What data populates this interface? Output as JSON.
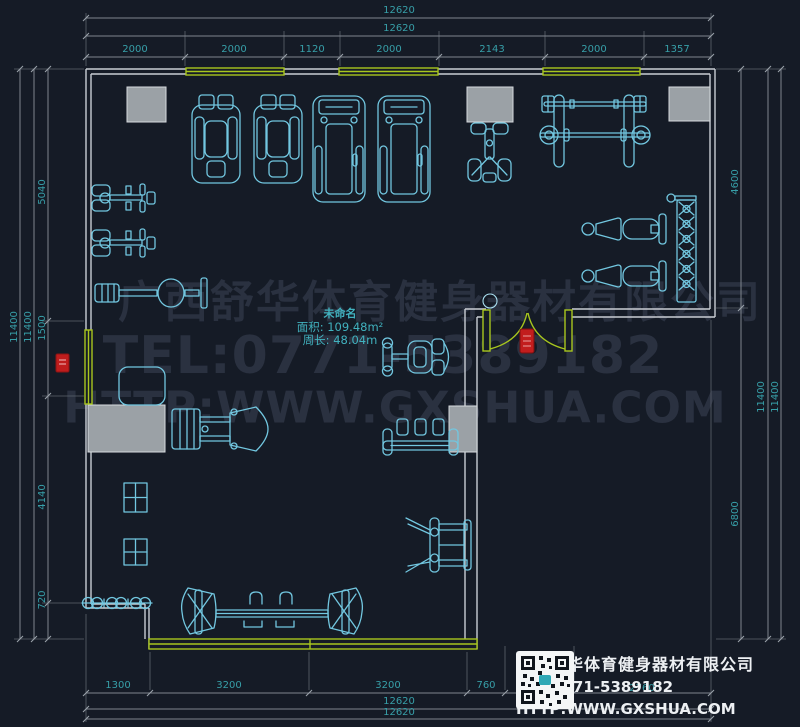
{
  "colors": {
    "background": "#151b26",
    "equipment_line": "#72c7e0",
    "wall_line": "#c9ced4",
    "window_green": "#a8c61e",
    "column_gray": "#9ba1a6",
    "dimension_text": "#379fa8",
    "watermark_gray": "#2a3140",
    "safety_red": "#c21d1d",
    "title_text": "#edf0f3"
  },
  "watermark": {
    "line1": "广西舒华体育健身器材有限公司",
    "line2": "TEL:0771-5389182",
    "line3": "HTTP:WWW.GXSHUA.COM"
  },
  "room_info": {
    "name": "未命名",
    "area": "面积: 109.48m²",
    "perimeter": "周长: 48.04m"
  },
  "title_block": {
    "company": "广西舒华体育健身器材有限公司",
    "tel": "TEL:0771-5389182",
    "website": "HTTP:WWW.GXSHUA.COM"
  },
  "dimensions": {
    "top": [
      {
        "text": "12620",
        "x": 399,
        "y": 11
      },
      {
        "text": "12620",
        "x": 399,
        "y": 29
      },
      {
        "text": "2000",
        "x": 135,
        "y": 50
      },
      {
        "text": "2000",
        "x": 234,
        "y": 50
      },
      {
        "text": "1120",
        "x": 312,
        "y": 50
      },
      {
        "text": "2000",
        "x": 389,
        "y": 50
      },
      {
        "text": "2143",
        "x": 492,
        "y": 50
      },
      {
        "text": "2000",
        "x": 594,
        "y": 50
      },
      {
        "text": "1357",
        "x": 677,
        "y": 50
      }
    ],
    "left": [
      {
        "text": "11400",
        "x": 15,
        "y": 327,
        "rot": 1
      },
      {
        "text": "11400",
        "x": 29,
        "y": 327,
        "rot": 1
      },
      {
        "text": "5040",
        "x": 43,
        "y": 192,
        "rot": 1
      },
      {
        "text": "1500",
        "x": 43,
        "y": 328,
        "rot": 1
      },
      {
        "text": "4140",
        "x": 43,
        "y": 497,
        "rot": 1
      },
      {
        "text": "720",
        "x": 43,
        "y": 600,
        "rot": 1
      }
    ],
    "right": [
      {
        "text": "4600",
        "x": 736,
        "y": 182,
        "rot": 1
      },
      {
        "text": "11400",
        "x": 762,
        "y": 397,
        "rot": 1
      },
      {
        "text": "11400",
        "x": 776,
        "y": 397,
        "rot": 1
      },
      {
        "text": "6800",
        "x": 736,
        "y": 514,
        "rot": 1
      }
    ],
    "bottom": [
      {
        "text": "1300",
        "x": 118,
        "y": 686
      },
      {
        "text": "3200",
        "x": 229,
        "y": 686
      },
      {
        "text": "3200",
        "x": 388,
        "y": 686
      },
      {
        "text": "760",
        "x": 486,
        "y": 686
      },
      {
        "text": "2760",
        "x": 642,
        "y": 689
      },
      {
        "text": "12620",
        "x": 399,
        "y": 702
      },
      {
        "text": "12620",
        "x": 399,
        "y": 713
      }
    ]
  }
}
